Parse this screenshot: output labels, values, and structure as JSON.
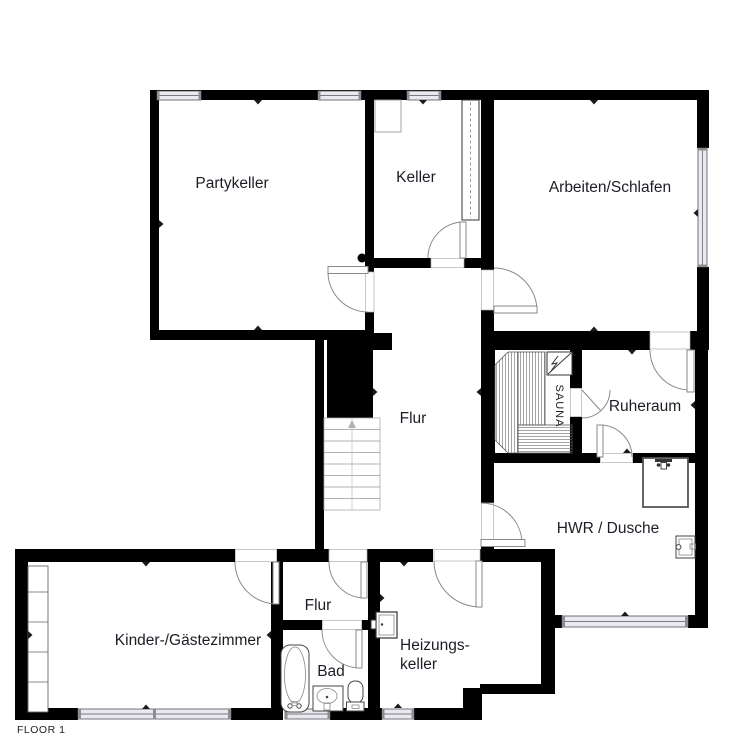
{
  "floor_label": "FLOOR 1",
  "rooms": {
    "partykeller": {
      "label": "Partykeller"
    },
    "keller": {
      "label": "Keller"
    },
    "arbeiten_schlafen": {
      "label": "Arbeiten/Schlafen"
    },
    "flur_main": {
      "label": "Flur"
    },
    "sauna": {
      "label": "SAUNA"
    },
    "ruheraum": {
      "label": "Ruheraum"
    },
    "hwr_dusche": {
      "label": "HWR / Dusche"
    },
    "kinder_gaestezimmer": {
      "label": "Kinder-/Gästezimmer"
    },
    "flur_small": {
      "label": "Flur"
    },
    "bad": {
      "label": "Bad"
    },
    "heizungskeller": {
      "label_line1": "Heizungs-",
      "label_line2": "keller"
    }
  },
  "symbols": [
    "stairs-up",
    "wardrobe",
    "bathtub",
    "sink",
    "toilet",
    "boiler",
    "shower",
    "sauna-heater",
    "sauna-bench",
    "door-swing",
    "window",
    "column-dot",
    "dimension-tick"
  ],
  "colors": {
    "wall": "#000000",
    "window_fill": "#e9eaf1",
    "door_line": "#8a8a8a",
    "fixture_line": "#444444",
    "label": "#1d1d26",
    "floor_label": "#222222",
    "background": "#ffffff"
  }
}
